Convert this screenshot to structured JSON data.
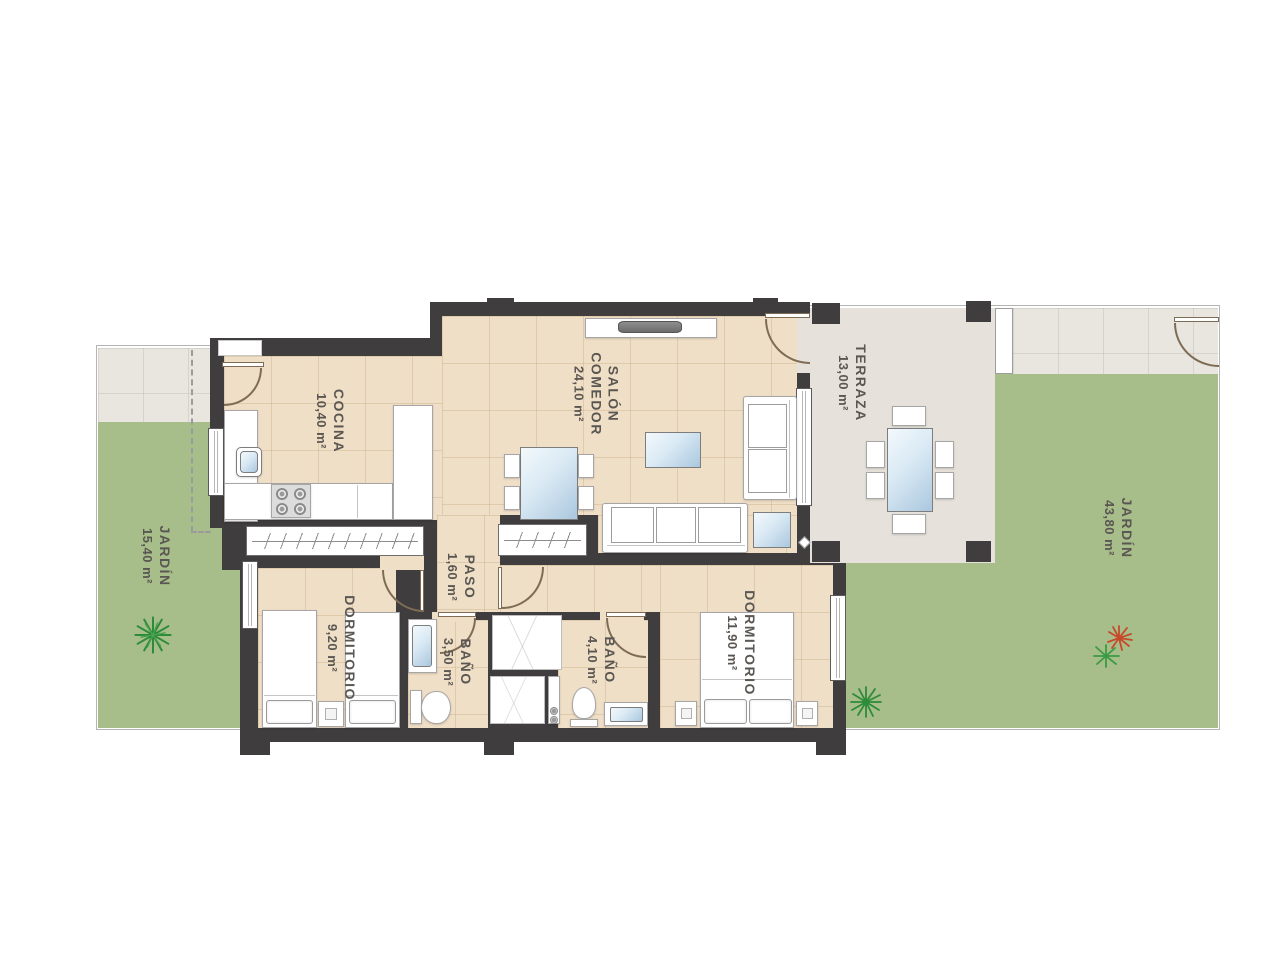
{
  "title": "Apartment floor plan",
  "rooms": {
    "cocina": {
      "name": "COCINA",
      "area": "10,40 m²"
    },
    "salon": {
      "name": "SALÓN",
      "name2": "COMEDOR",
      "area": "24,10 m²"
    },
    "terraza": {
      "name": "TERRAZA",
      "area": "13,00 m²"
    },
    "jardin_izq": {
      "name": "JARDÍN",
      "area": "15,40 m²"
    },
    "jardin_der": {
      "name": "JARDÍN",
      "area": "43,80 m²"
    },
    "dormitorio1": {
      "name": "DORMITORIO",
      "area": "9,20 m²"
    },
    "paso": {
      "name": "PASO",
      "area": "1,60 m²"
    },
    "bano1": {
      "name": "BAÑO",
      "area": "3,50 m²"
    },
    "bano2": {
      "name": "BAÑO",
      "area": "4,10 m²"
    },
    "dormitorio2": {
      "name": "DORMITORIO",
      "area": "11,90 m²"
    }
  },
  "colors": {
    "wall": "#3f3d3e",
    "floor": "#f0dfc7",
    "tile": "#e9e5df",
    "terr": "#e6e2db",
    "grass": "#a8be8a",
    "label": "#5a5652",
    "door": "#7e6c55"
  }
}
